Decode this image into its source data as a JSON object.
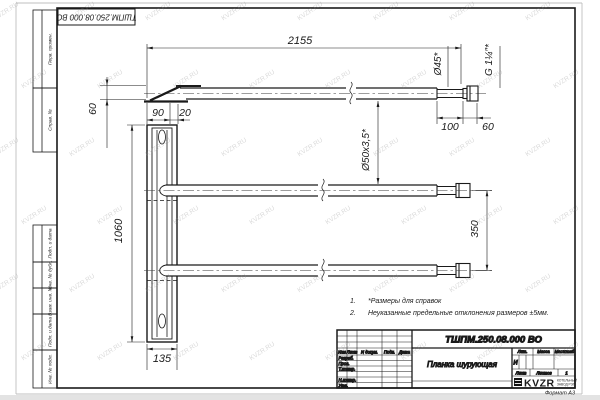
{
  "sheet": {
    "watermark": "KVZR.RU",
    "format_label": "Формат А3",
    "doc_number": "ТШПМ.250.08.000 ВО",
    "part_name": "Планка шурующая",
    "logo_text": "KVZR",
    "logo_sub_line1": "КОТЕЛЬНЫЙ",
    "logo_sub_line2": "ЗАВОД РЭП"
  },
  "margin_stamps": [
    "Перв. примен.",
    "Справ. №",
    "Подп. и дата",
    "Инв. № дубл.",
    "Взам. инв. №",
    "Подп. и дата",
    "Инв. № подл."
  ],
  "dimensions": {
    "total_length": "2155",
    "blade_height": "60",
    "blade_width": "90",
    "blade_lip": "20",
    "plank_length": "1060",
    "plank_width": "135",
    "tube_spacing": "350",
    "end_section_length": "100",
    "thread_length": "60",
    "end_diameter": "Ø45*",
    "tube_spec": "Ø50х3,5*",
    "thread_spec": "G 1¼″*"
  },
  "notes": [
    {
      "num": "1.",
      "text": "*Размеры для справок"
    },
    {
      "num": "2.",
      "text": "Неуказанные предельные отклонения размеров ±5мм."
    }
  ],
  "title_block": {
    "change_header": [
      "Изм",
      "Лист",
      "N докум.",
      "Подп.",
      "Дата"
    ],
    "role_rows": [
      "Разраб.",
      "Пров.",
      "Т.контр.",
      "",
      "Н.контр.",
      "Утв."
    ],
    "lit_label": "Лит.",
    "lit_value": "И",
    "mass_label": "Масса",
    "scale_label": "Масштаб",
    "sheet_label": "Лист",
    "sheets_label": "Листов",
    "sheets_value": "1"
  }
}
